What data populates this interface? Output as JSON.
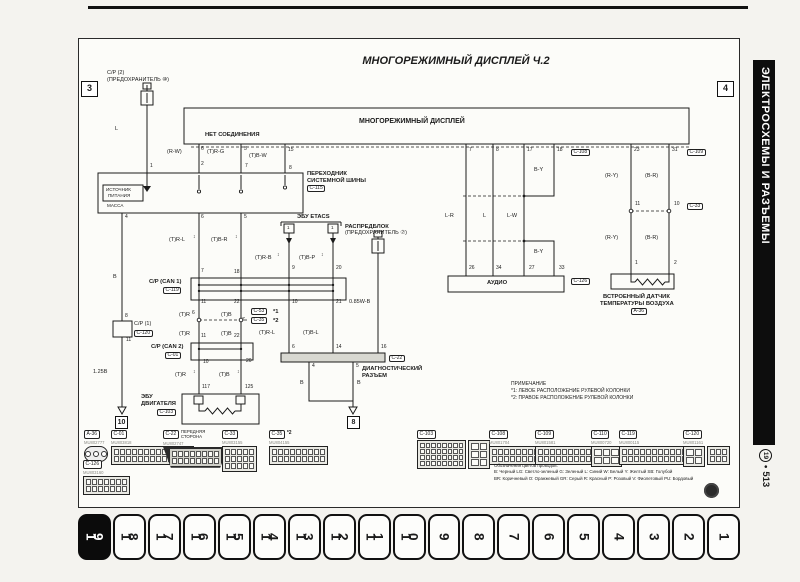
{
  "header": {
    "title": "МНОГОРЕЖИМНЫЙ ДИСПЛЕЙ Ч.2"
  },
  "sidebar": {
    "text": "ЭЛЕКТРОСХЕМЫ И РАЗЪЕМЫ",
    "page_circle": "19",
    "dot": "•",
    "page_num": "513"
  },
  "tabs": {
    "active": "19",
    "items": [
      "19",
      "18",
      "17",
      "16",
      "15",
      "14",
      "13",
      "12",
      "11",
      "10",
      "9",
      "8",
      "7",
      "6",
      "5",
      "4",
      "3",
      "2",
      "1"
    ]
  },
  "note": {
    "title": "ПРИМЕЧАНИЕ",
    "lines": [
      "*1: ЛЕВОЕ РАСПОЛОЖЕНИЕ РУЛЕВОЙ КОЛОНКИ",
      "*2: ПРАВОЕ РАСПОЛОЖЕНИЕ РУЛЕВОЙ КОЛОНКИ"
    ]
  },
  "legend": {
    "title": "Обозначения цветов проводов:",
    "lines": [
      "B: Черный LG: Светло-зеленый G: Зеленый L: Синий W: Белый Y: Желтый SB: Голубой",
      "BR: Коричневый O: Оранжевый GR: Серый R: Красный P: Розовый V: Фиолетовый PU: Бордовый"
    ]
  },
  "diagram": {
    "labels": [
      {
        "t": "C/P (2)",
        "x": 28,
        "y": 32
      },
      {
        "t": "(ПРЕДОХРАНИТЕЛЬ ⑩)",
        "x": 28,
        "y": 39
      },
      {
        "t": "L",
        "x": 36,
        "y": 88
      },
      {
        "t": "ИСТОЧНИК",
        "x": 27,
        "y": 149,
        "c": "xs"
      },
      {
        "t": "ПИТАНИЯ",
        "x": 29,
        "y": 155,
        "c": "xs"
      },
      {
        "t": "МАССА",
        "x": 28,
        "y": 165,
        "c": "xs"
      },
      {
        "t": "МНОГОРЕЖИМНЫЙ ДИСПЛЕЙ",
        "x": 280,
        "y": 79,
        "c": "lg",
        "n": "display-box-title"
      },
      {
        "t": "НЕТ СОЕДИНЕНИЯ",
        "x": 126,
        "y": 93,
        "c": "b"
      },
      {
        "t": "(R-W)",
        "x": 88,
        "y": 111
      },
      {
        "t": "(T)R-G",
        "x": 128,
        "y": 111
      },
      {
        "t": "(T)B-W",
        "x": 170,
        "y": 115
      },
      {
        "t": "ПЕРЕХОДНИК",
        "x": 228,
        "y": 132,
        "c": "b"
      },
      {
        "t": "СИСТЕМНОЙ ШИНЫ",
        "x": 228,
        "y": 139,
        "c": "b"
      },
      {
        "t": "ЭБУ ETACS",
        "x": 218,
        "y": 175,
        "c": "b"
      },
      {
        "t": "1",
        "x": 208,
        "y": 187,
        "c": "xs"
      },
      {
        "t": "1",
        "x": 252,
        "y": 187,
        "c": "xs"
      },
      {
        "t": "(T)R-L",
        "x": 90,
        "y": 199
      },
      {
        "t": "(T)B-R",
        "x": 132,
        "y": 199
      },
      {
        "t": "↕",
        "x": 114,
        "y": 196,
        "c": "ar"
      },
      {
        "t": "↕",
        "x": 156,
        "y": 196,
        "c": "ar"
      },
      {
        "t": "(T)R-B",
        "x": 176,
        "y": 217
      },
      {
        "t": "(T)B-P",
        "x": 220,
        "y": 217
      },
      {
        "t": "↕",
        "x": 198,
        "y": 214,
        "c": "ar"
      },
      {
        "t": "↕",
        "x": 242,
        "y": 214,
        "c": "ar"
      },
      {
        "t": "РАСПРЕДБЛОК",
        "x": 266,
        "y": 185,
        "c": "b"
      },
      {
        "t": "(ПРЕДОХРАНИТЕЛЬ ⑦)",
        "x": 266,
        "y": 192
      },
      {
        "t": "C/P (CAN 1)",
        "x": 70,
        "y": 240,
        "c": "b"
      },
      {
        "t": "(T)R",
        "x": 100,
        "y": 274
      },
      {
        "t": "(T)B",
        "x": 142,
        "y": 274
      },
      {
        "t": "*1",
        "x": 194,
        "y": 270,
        "c": "b"
      },
      {
        "t": "*2",
        "x": 194,
        "y": 279,
        "c": "b"
      },
      {
        "t": "(T)R",
        "x": 100,
        "y": 293
      },
      {
        "t": "(T)B",
        "x": 142,
        "y": 293
      },
      {
        "t": "C/P (CAN 2)",
        "x": 72,
        "y": 305,
        "c": "b"
      },
      {
        "t": "(T)R",
        "x": 96,
        "y": 334
      },
      {
        "t": "(T)B",
        "x": 140,
        "y": 334
      },
      {
        "t": "↕",
        "x": 114,
        "y": 331,
        "c": "ar"
      },
      {
        "t": "↕",
        "x": 158,
        "y": 331,
        "c": "ar"
      },
      {
        "t": "ЭБУ",
        "x": 62,
        "y": 355,
        "c": "b"
      },
      {
        "t": "ДВИГАТЕЛЯ",
        "x": 62,
        "y": 362,
        "c": "b"
      },
      {
        "t": "B",
        "x": 34,
        "y": 236
      },
      {
        "t": "C/P (1)",
        "x": 55,
        "y": 283
      },
      {
        "t": "1.25B",
        "x": 14,
        "y": 331
      },
      {
        "t": "(T)R-L",
        "x": 180,
        "y": 292
      },
      {
        "t": "(T)B-L",
        "x": 224,
        "y": 292
      },
      {
        "t": "0.85W-B",
        "x": 270,
        "y": 261
      },
      {
        "t": "ДИАГНОСТИЧЕСКИЙ",
        "x": 283,
        "y": 327,
        "c": "b"
      },
      {
        "t": "РАЗЪЕМ",
        "x": 283,
        "y": 334,
        "c": "b"
      },
      {
        "t": "B",
        "x": 221,
        "y": 342
      },
      {
        "t": "B",
        "x": 278,
        "y": 342
      },
      {
        "t": "L-R",
        "x": 366,
        "y": 175
      },
      {
        "t": "L",
        "x": 404,
        "y": 175
      },
      {
        "t": "L-W",
        "x": 428,
        "y": 175
      },
      {
        "t": "B-Y",
        "x": 455,
        "y": 129
      },
      {
        "t": "B-Y",
        "x": 455,
        "y": 211
      },
      {
        "t": "(R-Y)",
        "x": 526,
        "y": 135
      },
      {
        "t": "(B-R)",
        "x": 566,
        "y": 135
      },
      {
        "t": "(R-Y)",
        "x": 526,
        "y": 197
      },
      {
        "t": "(B-R)",
        "x": 566,
        "y": 197
      },
      {
        "t": "АУДИО",
        "x": 408,
        "y": 241,
        "c": "b",
        "n": "audio-box-title"
      },
      {
        "t": "ВСТРОЕННЫЙ ДАТЧИК",
        "x": 524,
        "y": 255,
        "c": "b"
      },
      {
        "t": "ТЕМПЕРАТУРЫ ВОЗДУХА",
        "x": 521,
        "y": 262,
        "c": "b"
      }
    ],
    "pins": [
      {
        "t": "1",
        "x": 71,
        "y": 125
      },
      {
        "t": "6",
        "x": 122,
        "y": 108
      },
      {
        "t": "5",
        "x": 165,
        "y": 108
      },
      {
        "t": "15",
        "x": 209,
        "y": 109
      },
      {
        "t": "2",
        "x": 122,
        "y": 123
      },
      {
        "t": "7",
        "x": 166,
        "y": 125
      },
      {
        "t": "8",
        "x": 210,
        "y": 127
      },
      {
        "t": "4",
        "x": 46,
        "y": 176
      },
      {
        "t": "6",
        "x": 122,
        "y": 176
      },
      {
        "t": "5",
        "x": 165,
        "y": 176
      },
      {
        "t": "9",
        "x": 213,
        "y": 227
      },
      {
        "t": "20",
        "x": 257,
        "y": 227
      },
      {
        "t": "7",
        "x": 122,
        "y": 230
      },
      {
        "t": "18",
        "x": 155,
        "y": 231
      },
      {
        "t": "11",
        "x": 122,
        "y": 261
      },
      {
        "t": "22",
        "x": 155,
        "y": 261
      },
      {
        "t": "10",
        "x": 213,
        "y": 261
      },
      {
        "t": "21",
        "x": 257,
        "y": 261
      },
      {
        "t": "6",
        "x": 113,
        "y": 272
      },
      {
        "t": "7",
        "x": 163,
        "y": 279
      },
      {
        "t": "11",
        "x": 122,
        "y": 295
      },
      {
        "t": "22",
        "x": 155,
        "y": 295
      },
      {
        "t": "10",
        "x": 124,
        "y": 321
      },
      {
        "t": "20",
        "x": 167,
        "y": 320
      },
      {
        "t": "117",
        "x": 123,
        "y": 346
      },
      {
        "t": "125",
        "x": 166,
        "y": 346
      },
      {
        "t": "8",
        "x": 46,
        "y": 275
      },
      {
        "t": "11",
        "x": 47,
        "y": 299
      },
      {
        "t": "7",
        "x": 390,
        "y": 109
      },
      {
        "t": "8",
        "x": 417,
        "y": 109
      },
      {
        "t": "17",
        "x": 448,
        "y": 109
      },
      {
        "t": "18",
        "x": 478,
        "y": 109
      },
      {
        "t": "23",
        "x": 555,
        "y": 109
      },
      {
        "t": "31",
        "x": 593,
        "y": 109
      },
      {
        "t": "26",
        "x": 390,
        "y": 227
      },
      {
        "t": "34",
        "x": 417,
        "y": 227
      },
      {
        "t": "27",
        "x": 450,
        "y": 227
      },
      {
        "t": "33",
        "x": 480,
        "y": 227
      },
      {
        "t": "11",
        "x": 556,
        "y": 163
      },
      {
        "t": "10",
        "x": 595,
        "y": 163
      },
      {
        "t": "1",
        "x": 556,
        "y": 222
      },
      {
        "t": "2",
        "x": 595,
        "y": 222
      },
      {
        "t": "6",
        "x": 213,
        "y": 306
      },
      {
        "t": "14",
        "x": 257,
        "y": 306
      },
      {
        "t": "16",
        "x": 302,
        "y": 306
      },
      {
        "t": "4",
        "x": 233,
        "y": 325
      },
      {
        "t": "5",
        "x": 277,
        "y": 325
      }
    ],
    "boxed": [
      {
        "t": "C-115",
        "x": 228,
        "y": 146
      },
      {
        "t": "C-119",
        "x": 84,
        "y": 248
      },
      {
        "t": "C-53",
        "x": 172,
        "y": 269
      },
      {
        "t": "C-35",
        "x": 172,
        "y": 278
      },
      {
        "t": "C-01",
        "x": 86,
        "y": 313
      },
      {
        "t": "C-120",
        "x": 55,
        "y": 291
      },
      {
        "t": "C-103",
        "x": 78,
        "y": 370
      },
      {
        "t": "C-22",
        "x": 310,
        "y": 316
      },
      {
        "t": "C-108",
        "x": 492,
        "y": 110
      },
      {
        "t": "C-109",
        "x": 608,
        "y": 110
      },
      {
        "t": "C-33",
        "x": 608,
        "y": 164
      },
      {
        "t": "C-126",
        "x": 492,
        "y": 239
      },
      {
        "t": "A-36",
        "x": 552,
        "y": 269
      }
    ],
    "refs": [
      {
        "t": "3",
        "x": 2,
        "y": 42
      },
      {
        "t": "4",
        "x": 638,
        "y": 42
      },
      {
        "t": "10",
        "x": 36,
        "y": 377,
        "s": 1
      },
      {
        "t": "8",
        "x": 268,
        "y": 377,
        "s": 1
      }
    ]
  },
  "connectors": [
    {
      "id": "A-36",
      "code": "MU802777",
      "shape": "round",
      "x": 5,
      "y": 391
    },
    {
      "id": "C-01",
      "code": "MU803818",
      "shape": "r13x2",
      "x": 32,
      "y": 391
    },
    {
      "id": "C-22",
      "code": "MU802747",
      "shape": "obd",
      "x": 84,
      "y": 391,
      "note": "ПЕРЕДНЯЯ СТОРОНА"
    },
    {
      "id": "C-33",
      "code": "MU803155",
      "shape": "r5x3",
      "x": 143,
      "y": 391
    },
    {
      "id": "C-35",
      "code": "MU804155",
      "shape": "r9x2",
      "x": 190,
      "y": 391,
      "star": "*2"
    },
    {
      "id": "C-126",
      "code": "MU803160",
      "shape": "r7x2",
      "x": 4,
      "y": 421
    },
    {
      "id": "C-103",
      "code": "",
      "shape": "big",
      "x": 338,
      "y": 391
    },
    {
      "id": "C-108",
      "code": "MU801704",
      "shape": "r11x2",
      "x": 410,
      "y": 391
    },
    {
      "id": "C-109",
      "code": "MU801581",
      "shape": "r12x2",
      "x": 456,
      "y": 391
    },
    {
      "id": "C-110",
      "code": "MU800720",
      "shape": "r3x2l",
      "x": 512,
      "y": 391
    },
    {
      "id": "C-119",
      "code": "MU800115",
      "shape": "r12x2",
      "x": 540,
      "y": 391
    },
    {
      "id": "C-120",
      "code": "MU801161",
      "shape": "mix",
      "x": 604,
      "y": 391
    }
  ]
}
